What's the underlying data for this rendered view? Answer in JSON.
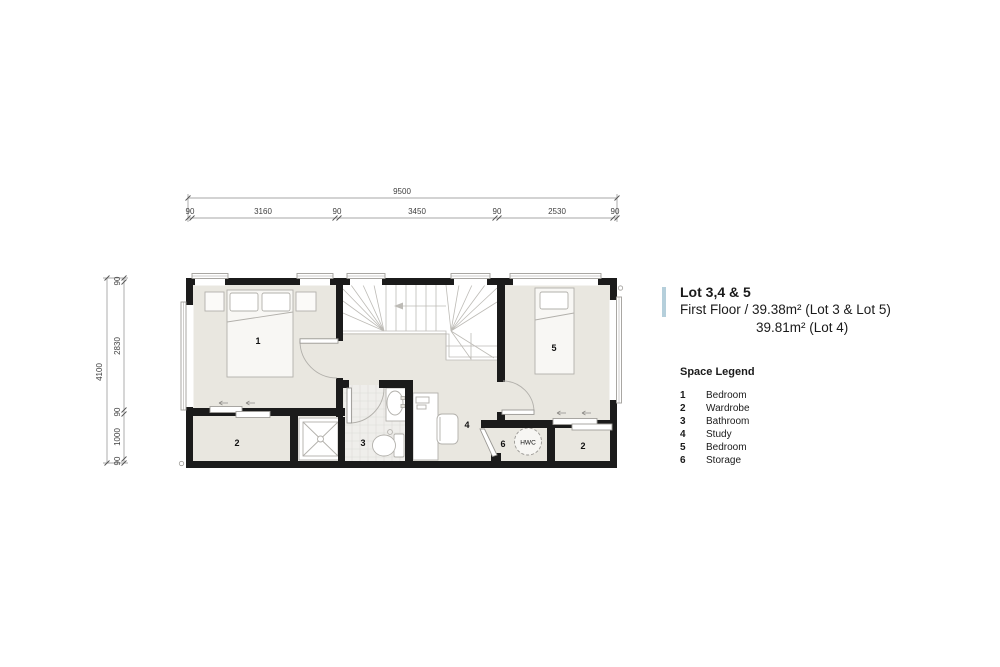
{
  "title_block": {
    "lot_title": "Lot 3,4 & 5",
    "line1": "First Floor / 39.38m² (Lot 3 & Lot 5)",
    "line2": "39.81m² (Lot 4)",
    "accent_color": "#b5cfdb"
  },
  "legend": {
    "heading": "Space Legend",
    "items": [
      {
        "num": "1",
        "label": "Bedroom"
      },
      {
        "num": "2",
        "label": "Wardrobe"
      },
      {
        "num": "3",
        "label": "Bathroom"
      },
      {
        "num": "4",
        "label": "Study"
      },
      {
        "num": "5",
        "label": "Bedroom"
      },
      {
        "num": "6",
        "label": "Storage"
      }
    ]
  },
  "plan": {
    "room_labels": {
      "r1": "1",
      "r2_left": "2",
      "r3": "3",
      "r4": "4",
      "r5": "5",
      "r6": "6",
      "r2_right": "2",
      "hwc": "HWC"
    },
    "dimensions": {
      "top_total": "9500",
      "top_segments": [
        "90",
        "3160",
        "90",
        "3450",
        "90",
        "2530",
        "90"
      ],
      "left_total": "4100",
      "left_segments": [
        "90",
        "2830",
        "90",
        "1000",
        "90"
      ]
    },
    "colors": {
      "wall": "#1b1b1b",
      "floor": "#e9e7e0",
      "tile_bg": "#efeeeb",
      "line": "#b2b0ab",
      "dim_line": "#8a8a8a"
    }
  }
}
